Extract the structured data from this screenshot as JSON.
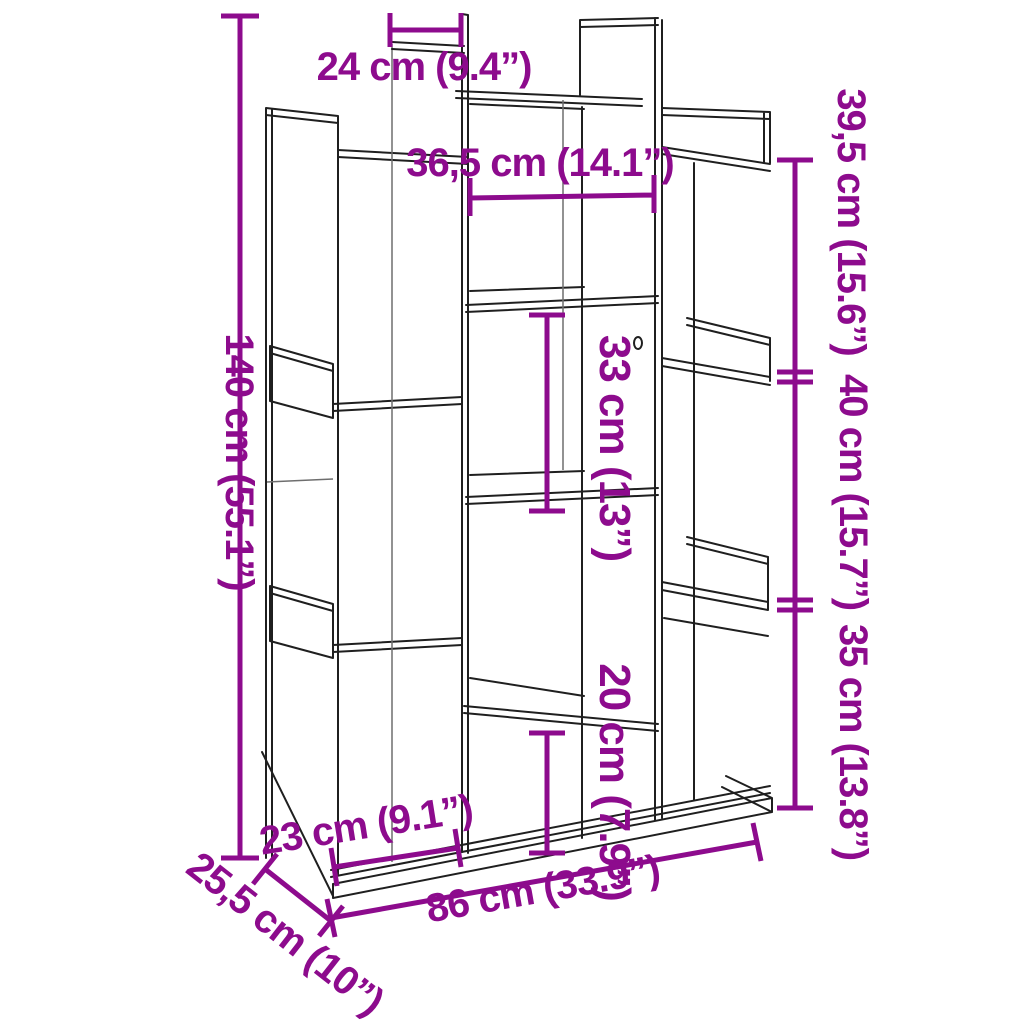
{
  "figure": {
    "type": "furniture-dimension-diagram",
    "subject": "tree-shaped book cabinet line drawing with measurements",
    "background": "#ffffff"
  },
  "colors": {
    "dimension_accent": "#8D0B8D",
    "outline": "#1F1F1F"
  },
  "dimensions": {
    "height_total": {
      "label": "140 cm (55.1”)",
      "cm": 140,
      "inch": 55.1,
      "orientation": "vertical-left"
    },
    "width_total": {
      "label": "86 cm (33.9”)",
      "cm": 86,
      "inch": 33.9,
      "orientation": "bottom-width"
    },
    "depth_total": {
      "label": "25,5 cm (10”)",
      "cm": 25.5,
      "inch": 10,
      "orientation": "bottom-depth"
    },
    "top_cubby_width": {
      "label": "24 cm (9.4”)",
      "cm": 24,
      "inch": 9.4,
      "orientation": "horizontal-top"
    },
    "upper_middle_width": {
      "label": "36,5 cm (14.1”)",
      "cm": 36.5,
      "inch": 14.1,
      "orientation": "horizontal-upper"
    },
    "right_upper_height": {
      "label": "39,5 cm (15.6”)",
      "cm": 39.5,
      "inch": 15.6,
      "orientation": "vertical-right"
    },
    "right_middle_height": {
      "label": "40 cm (15.7”)",
      "cm": 40,
      "inch": 15.7,
      "orientation": "vertical-right"
    },
    "right_lower_height": {
      "label": "35 cm (13.8”)",
      "cm": 35,
      "inch": 13.8,
      "orientation": "vertical-right"
    },
    "middle_cubby_height": {
      "label": "33 cm (13”)",
      "cm": 33,
      "inch": 13,
      "orientation": "vertical-middle"
    },
    "lower_middle_height": {
      "label": "20 cm (7.9”)",
      "cm": 20,
      "inch": 7.9,
      "orientation": "vertical-middle"
    },
    "bottom_left_width": {
      "label": "23 cm (9.1”)",
      "cm": 23,
      "inch": 9.1,
      "orientation": "bottom-width-left"
    }
  }
}
